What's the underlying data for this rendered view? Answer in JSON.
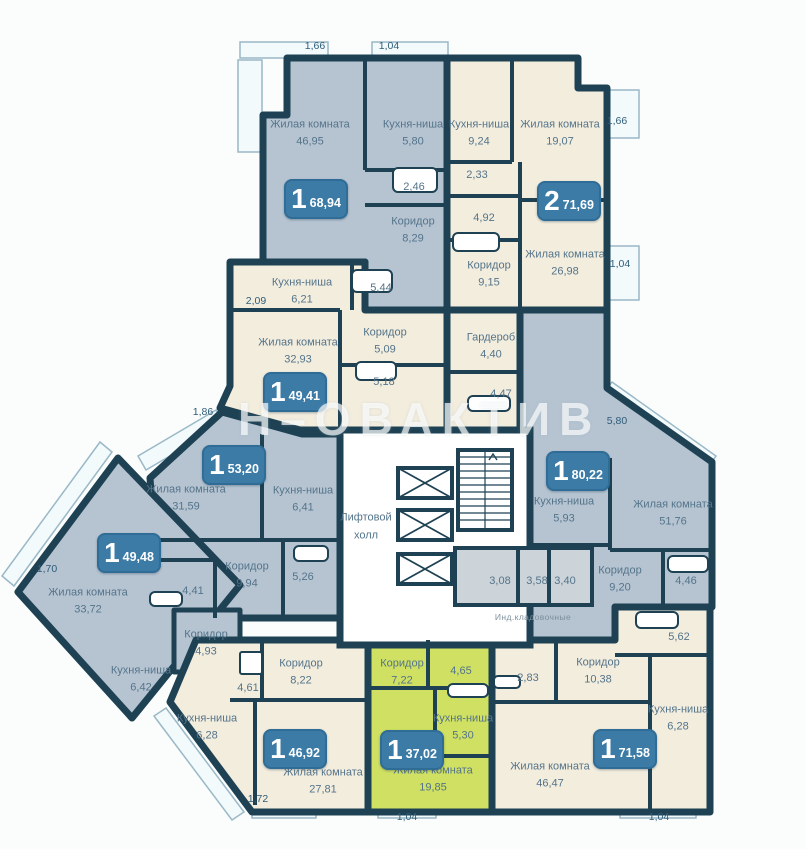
{
  "watermark": "Н–ОВАКТИВ",
  "core": {
    "elevator_hall_line1": "Лифтовой",
    "elevator_hall_line2": "холл",
    "storage_caption": "Инд.кладовочные"
  },
  "badges": [
    {
      "num": "1",
      "area": "68,94"
    },
    {
      "num": "2",
      "area": "71,69"
    },
    {
      "num": "1",
      "area": "49,41"
    },
    {
      "num": "1",
      "area": "53,20"
    },
    {
      "num": "1",
      "area": "49,48"
    },
    {
      "num": "1",
      "area": "80,22"
    },
    {
      "num": "1",
      "area": "46,92"
    },
    {
      "num": "1",
      "area": "37,02"
    },
    {
      "num": "1",
      "area": "71,58"
    }
  ],
  "rooms": [
    {
      "name": "Жилая комната",
      "area": "46,95"
    },
    {
      "name": "Кухня-ниша",
      "area": "5,80"
    },
    {
      "name": "Кухня-ниша",
      "area": "9,24"
    },
    {
      "name": "Жилая комната",
      "area": "19,07"
    },
    {
      "area": "2,46"
    },
    {
      "area": "2,33"
    },
    {
      "name": "Коридор",
      "area": "8,29"
    },
    {
      "area": "4,92"
    },
    {
      "name": "Коридор",
      "area": "9,15"
    },
    {
      "name": "Жилая комната",
      "area": "26,98"
    },
    {
      "name": "Кухня-ниша",
      "area": "6,21"
    },
    {
      "area": "5,44"
    },
    {
      "name": "Коридор",
      "area": "5,09"
    },
    {
      "name": "Жилая комната",
      "area": "32,93"
    },
    {
      "area": "5,18"
    },
    {
      "name": "Гардероб",
      "area": "4,40"
    },
    {
      "area": "4,47"
    },
    {
      "name": "Жилая комната",
      "area": "31,59"
    },
    {
      "name": "Кухня-ниша",
      "area": "6,41"
    },
    {
      "name": "Коридор",
      "area": "9,94"
    },
    {
      "area": "5,26"
    },
    {
      "area": "4,41"
    },
    {
      "name": "Жилая комната",
      "area": "33,72"
    },
    {
      "name": "Кухня-ниша",
      "area": "6,42"
    },
    {
      "name": "Коридор",
      "area": "4,93"
    },
    {
      "area": "4,61"
    },
    {
      "name": "Кухня-ниша",
      "area": "5,93"
    },
    {
      "name": "Жилая комната",
      "area": "51,76"
    },
    {
      "name": "Коридор",
      "area": "9,20"
    },
    {
      "area": "4,46"
    },
    {
      "area": "5,62"
    },
    {
      "area": "3,08"
    },
    {
      "area": "3,58"
    },
    {
      "area": "3,40"
    },
    {
      "name": "Кухня-ниша",
      "area": "6,28"
    },
    {
      "name": "Коридор",
      "area": "8,22"
    },
    {
      "name": "Жилая комната",
      "area": "27,81"
    },
    {
      "name": "Коридор",
      "area": "7,22"
    },
    {
      "area": "4,65"
    },
    {
      "name": "Кухня-ниша",
      "area": "5,30"
    },
    {
      "name": "Жилая комната",
      "area": "19,85"
    },
    {
      "area": "2,83"
    },
    {
      "name": "Коридор",
      "area": "10,38"
    },
    {
      "name": "Жилая комната",
      "area": "46,47"
    },
    {
      "name": "Кухня-ниша",
      "area": "6,28"
    }
  ],
  "dimensions": [
    "1,66",
    "1,04",
    "1,66",
    "1,04",
    "5,80",
    "2,09",
    "1,86",
    "1,70",
    "1,72",
    "1,04",
    "1,04"
  ],
  "colors": {
    "wall": "#1e4254",
    "apartment_blue": "#b6c4d2",
    "apartment_cream": "#f3edde",
    "apartment_green": "#cfe063",
    "storage_grey": "#ccd4da",
    "badge_blue": "#3b7ba6",
    "balcony": "#f2fafc"
  }
}
